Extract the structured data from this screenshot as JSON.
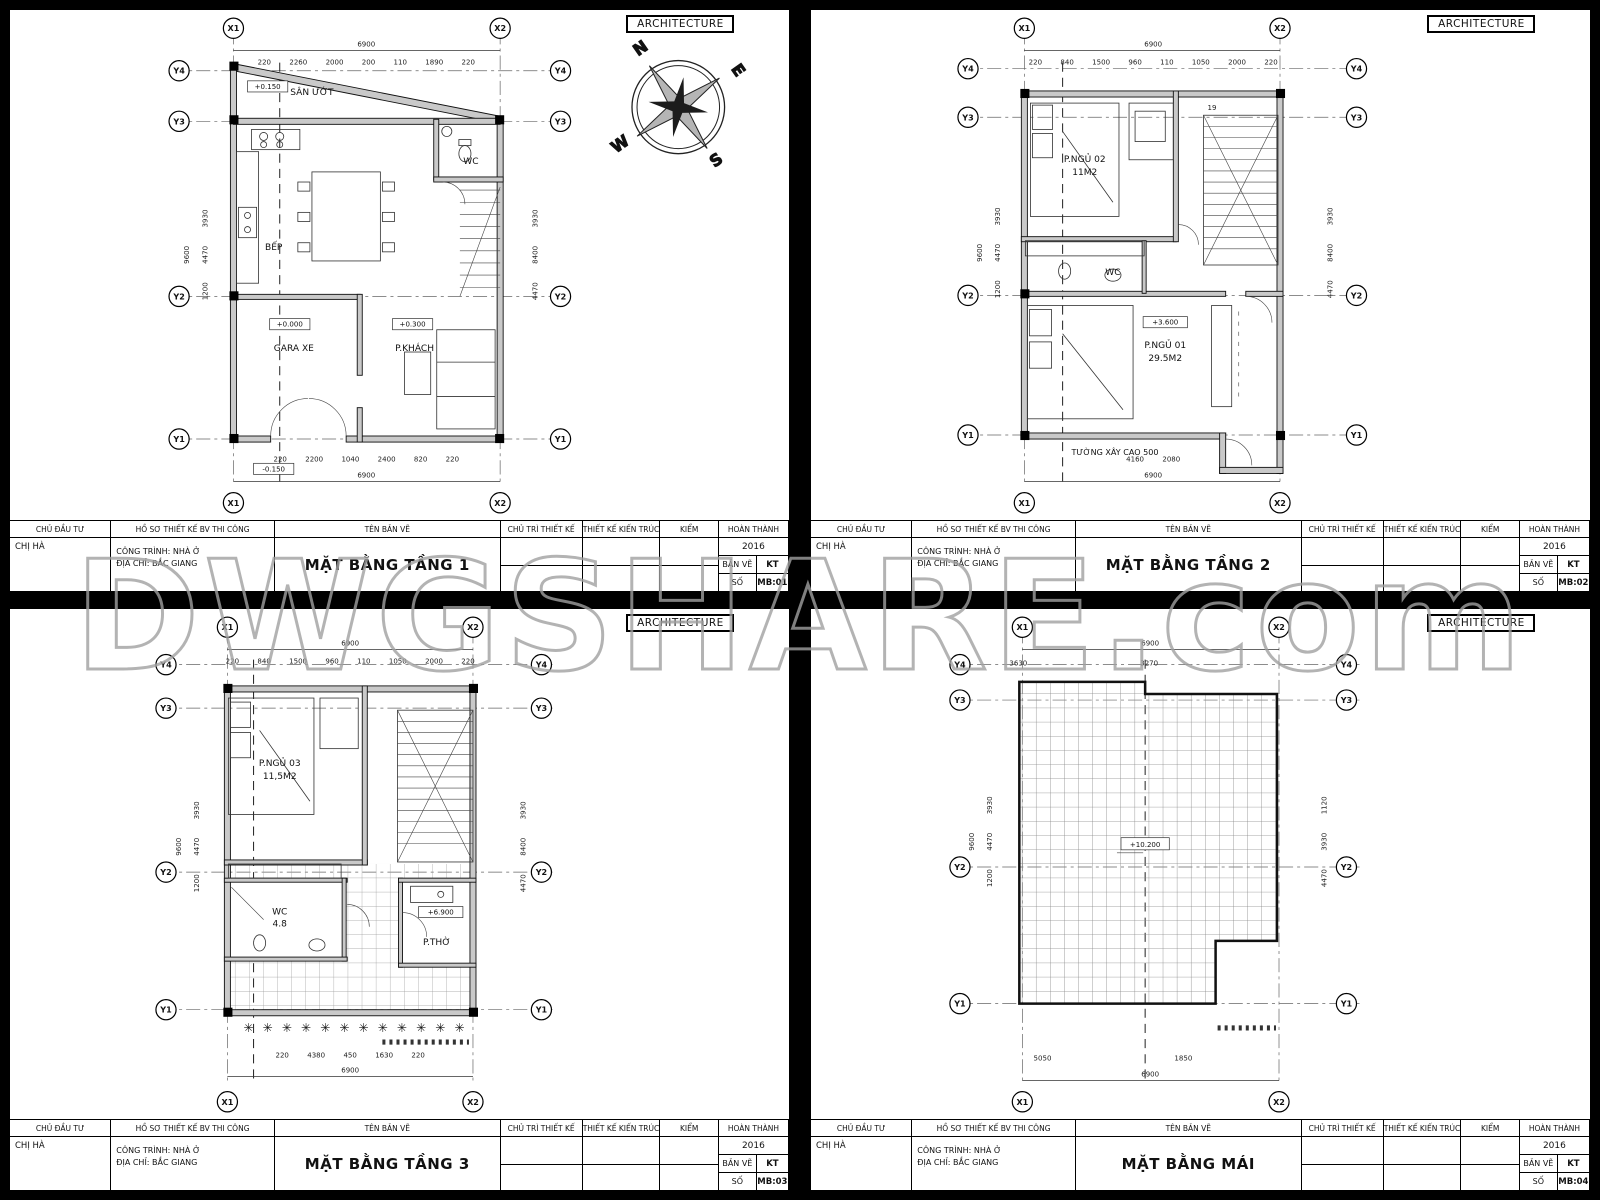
{
  "watermark": "DWGSHARE.com",
  "compass": {
    "n": "N",
    "e": "E",
    "s": "S",
    "w": "W"
  },
  "titleblock": {
    "headers": [
      "CHỦ ĐẦU TƯ",
      "HỒ SƠ THIẾT KẾ BV THI CÔNG",
      "TÊN BẢN VẼ",
      "CHỦ TRÌ THIẾT KẾ",
      "THIẾT KẾ KIẾN TRÚC",
      "KIỂM",
      "HOÀN THÀNH"
    ],
    "client": "CHỊ HÀ",
    "project": "CÔNG TRÌNH: NHÀ Ở",
    "address": "ĐỊA CHỈ: BẮC GIANG",
    "year": "2016",
    "ban_ve_label": "BẢN VẼ",
    "so_label": "SỐ",
    "kt": "KT"
  },
  "axes": {
    "x1": "X1",
    "x2": "X2",
    "y1": "Y1",
    "y2": "Y2",
    "y3": "Y3",
    "y4": "Y4"
  },
  "panels": [
    {
      "tab": "ARCHITECTURE",
      "title": "MẶT BẰNG TẦNG 1",
      "sheet_no": "MB:01",
      "dims": {
        "top_total": "6900",
        "top_segs": "220 2260 2000 200 110 1890 220",
        "bottom_segs": "220 2200 1040 2400 820 220",
        "bottom_total": "6900",
        "left_total": "9600",
        "left_segs": "1200 4470 3930",
        "right_segs": "4470 8400 3930"
      },
      "labels": {
        "room1": "SÂN ƯỚT",
        "room1_level": "+0.150",
        "room2": "BẾP",
        "room3": "WC",
        "room4": "GARA XE",
        "room4_level": "+0.000",
        "room5": "P.KHÁCH",
        "room5_level": "+0.300",
        "entry_level": "-0.150"
      }
    },
    {
      "tab": "ARCHITECTURE",
      "title": "MẶT BẰNG TẦNG 2",
      "sheet_no": "MB:02",
      "dims": {
        "top_total": "6900",
        "top_segs": "220 840 1500 960 110 1050 2000 220",
        "bottom_segs": "4160 2080",
        "bottom_total": "6900",
        "left_total": "9600",
        "left_segs": "1200 4470 3930",
        "right_segs": "4470 8400 3930"
      },
      "labels": {
        "room1": "P.NGỦ 02",
        "room1_area": "11M2",
        "room2": "WC",
        "room3": "P.NGỦ 01",
        "room3_area": "29.5M2",
        "level": "+3.600",
        "note": "TƯỜNG XÂY CAO 500",
        "stair_note": "19"
      }
    },
    {
      "tab": "ARCHITECTURE",
      "title": "MẶT BẰNG TẦNG 3",
      "sheet_no": "MB:03",
      "dims": {
        "top_total": "6900",
        "top_segs": "220 840 1500 960 110 1050 2000 220",
        "bottom_segs": "220 4380 450 1630 220",
        "bottom_total": "6900",
        "left_total": "9600",
        "left_segs": "1200 4470 3930",
        "right_segs": "4470 8400 3930"
      },
      "labels": {
        "room1": "P.NGỦ 03",
        "room1_area": "11,5M2",
        "room2": "WC",
        "room2_area": "4.8",
        "room3": "P.THỜ",
        "level": "+6.900"
      }
    },
    {
      "tab": "ARCHITECTURE",
      "title": "MẶT BẰNG MÁI",
      "sheet_no": "MB:04",
      "dims": {
        "top_total": "6900",
        "top_segs": "3630 3270",
        "bottom_segs": "5050 1850",
        "bottom_total": "6900",
        "left_total": "9600",
        "left_segs": "1200 4470 3930",
        "right_segs": "4470 3930 1120"
      },
      "labels": {
        "level": "+10.200"
      }
    }
  ]
}
